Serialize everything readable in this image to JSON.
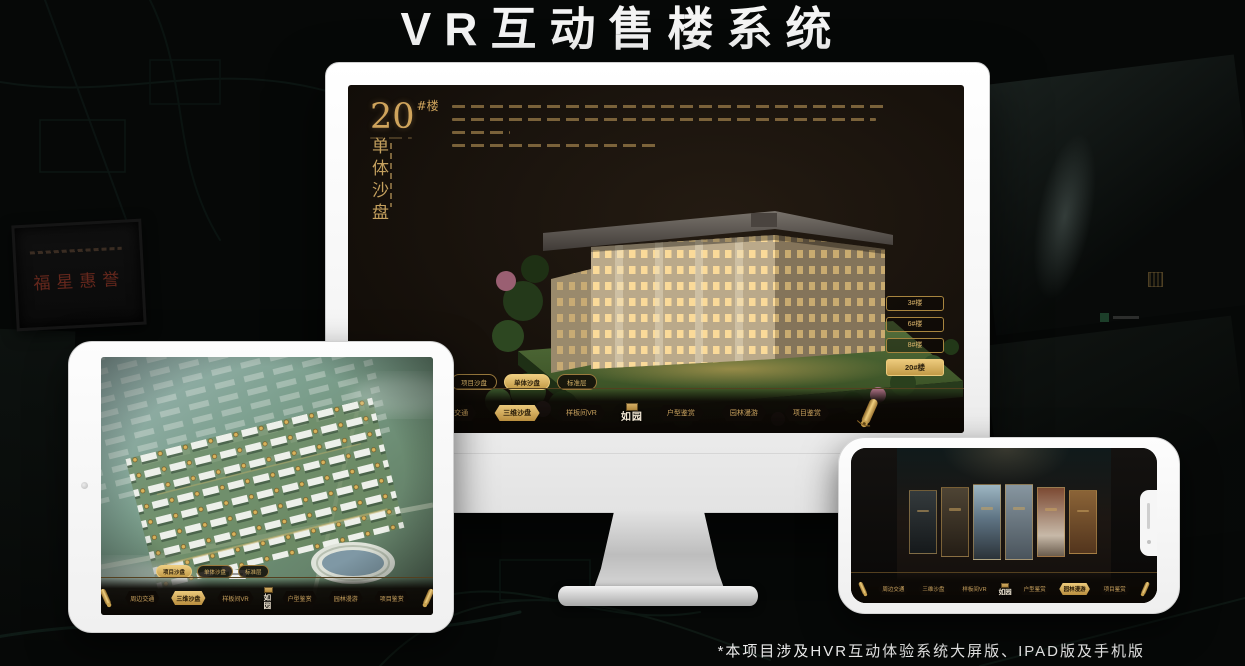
{
  "page": {
    "title": "VR互动售楼系统",
    "footnote": "*本项目涉及HVR互动体验系统大屏版、IPAD版及手机版"
  },
  "colors": {
    "gold": "#c9a25e",
    "gold_bright": "#e9c070",
    "gold_fill_text": "#2b1f0c",
    "screen_bg": "#1a130c",
    "monitor_body": "#f2f2f2"
  },
  "desktop": {
    "heading": {
      "number": "20",
      "suffix": "#楼",
      "vertical": "单体沙盘"
    },
    "floor_buttons": [
      {
        "label": "3#楼",
        "active": false
      },
      {
        "label": "6#楼",
        "active": false
      },
      {
        "label": "8#楼",
        "active": false
      },
      {
        "label": "20#楼",
        "active": true
      }
    ],
    "tabs": [
      {
        "label": "项目沙盘",
        "active": false
      },
      {
        "label": "单体沙盘",
        "active": true
      },
      {
        "label": "标准层",
        "active": false
      }
    ],
    "nav": {
      "logo": "如园",
      "items": [
        {
          "label": "周边交通",
          "active": false
        },
        {
          "label": "三维沙盘",
          "active": true
        },
        {
          "label": "样板间VR",
          "active": false
        },
        {
          "label": "户型鉴赏",
          "active": false
        },
        {
          "label": "园林漫游",
          "active": false
        },
        {
          "label": "项目鉴赏",
          "active": false
        }
      ]
    }
  },
  "tablet": {
    "tabs": [
      {
        "label": "项目沙盘",
        "active": true
      },
      {
        "label": "单体沙盘",
        "active": false
      },
      {
        "label": "标准层",
        "active": false
      }
    ],
    "nav": {
      "logo": "如园",
      "items": [
        {
          "label": "周边交通",
          "active": false
        },
        {
          "label": "三维沙盘",
          "active": true
        },
        {
          "label": "样板间VR",
          "active": false
        },
        {
          "label": "户型鉴赏",
          "active": false
        },
        {
          "label": "园林漫游",
          "active": false
        },
        {
          "label": "项目鉴赏",
          "active": false
        }
      ]
    }
  },
  "phone": {
    "gallery": {
      "count": 6,
      "card_tones": [
        "#343a3c",
        "#4e4434",
        "#9db6c2",
        "#8796a0",
        "#7c4a33",
        "#8a6337"
      ]
    },
    "nav": {
      "logo": "如园",
      "items": [
        {
          "label": "周边交通",
          "active": false
        },
        {
          "label": "三维沙盘",
          "active": false
        },
        {
          "label": "样板间VR",
          "active": false
        },
        {
          "label": "户型鉴赏",
          "active": false
        },
        {
          "label": "园林漫游",
          "active": true
        },
        {
          "label": "项目鉴赏",
          "active": false
        }
      ]
    }
  },
  "background": {
    "plaque_text": "福星惠誉"
  }
}
